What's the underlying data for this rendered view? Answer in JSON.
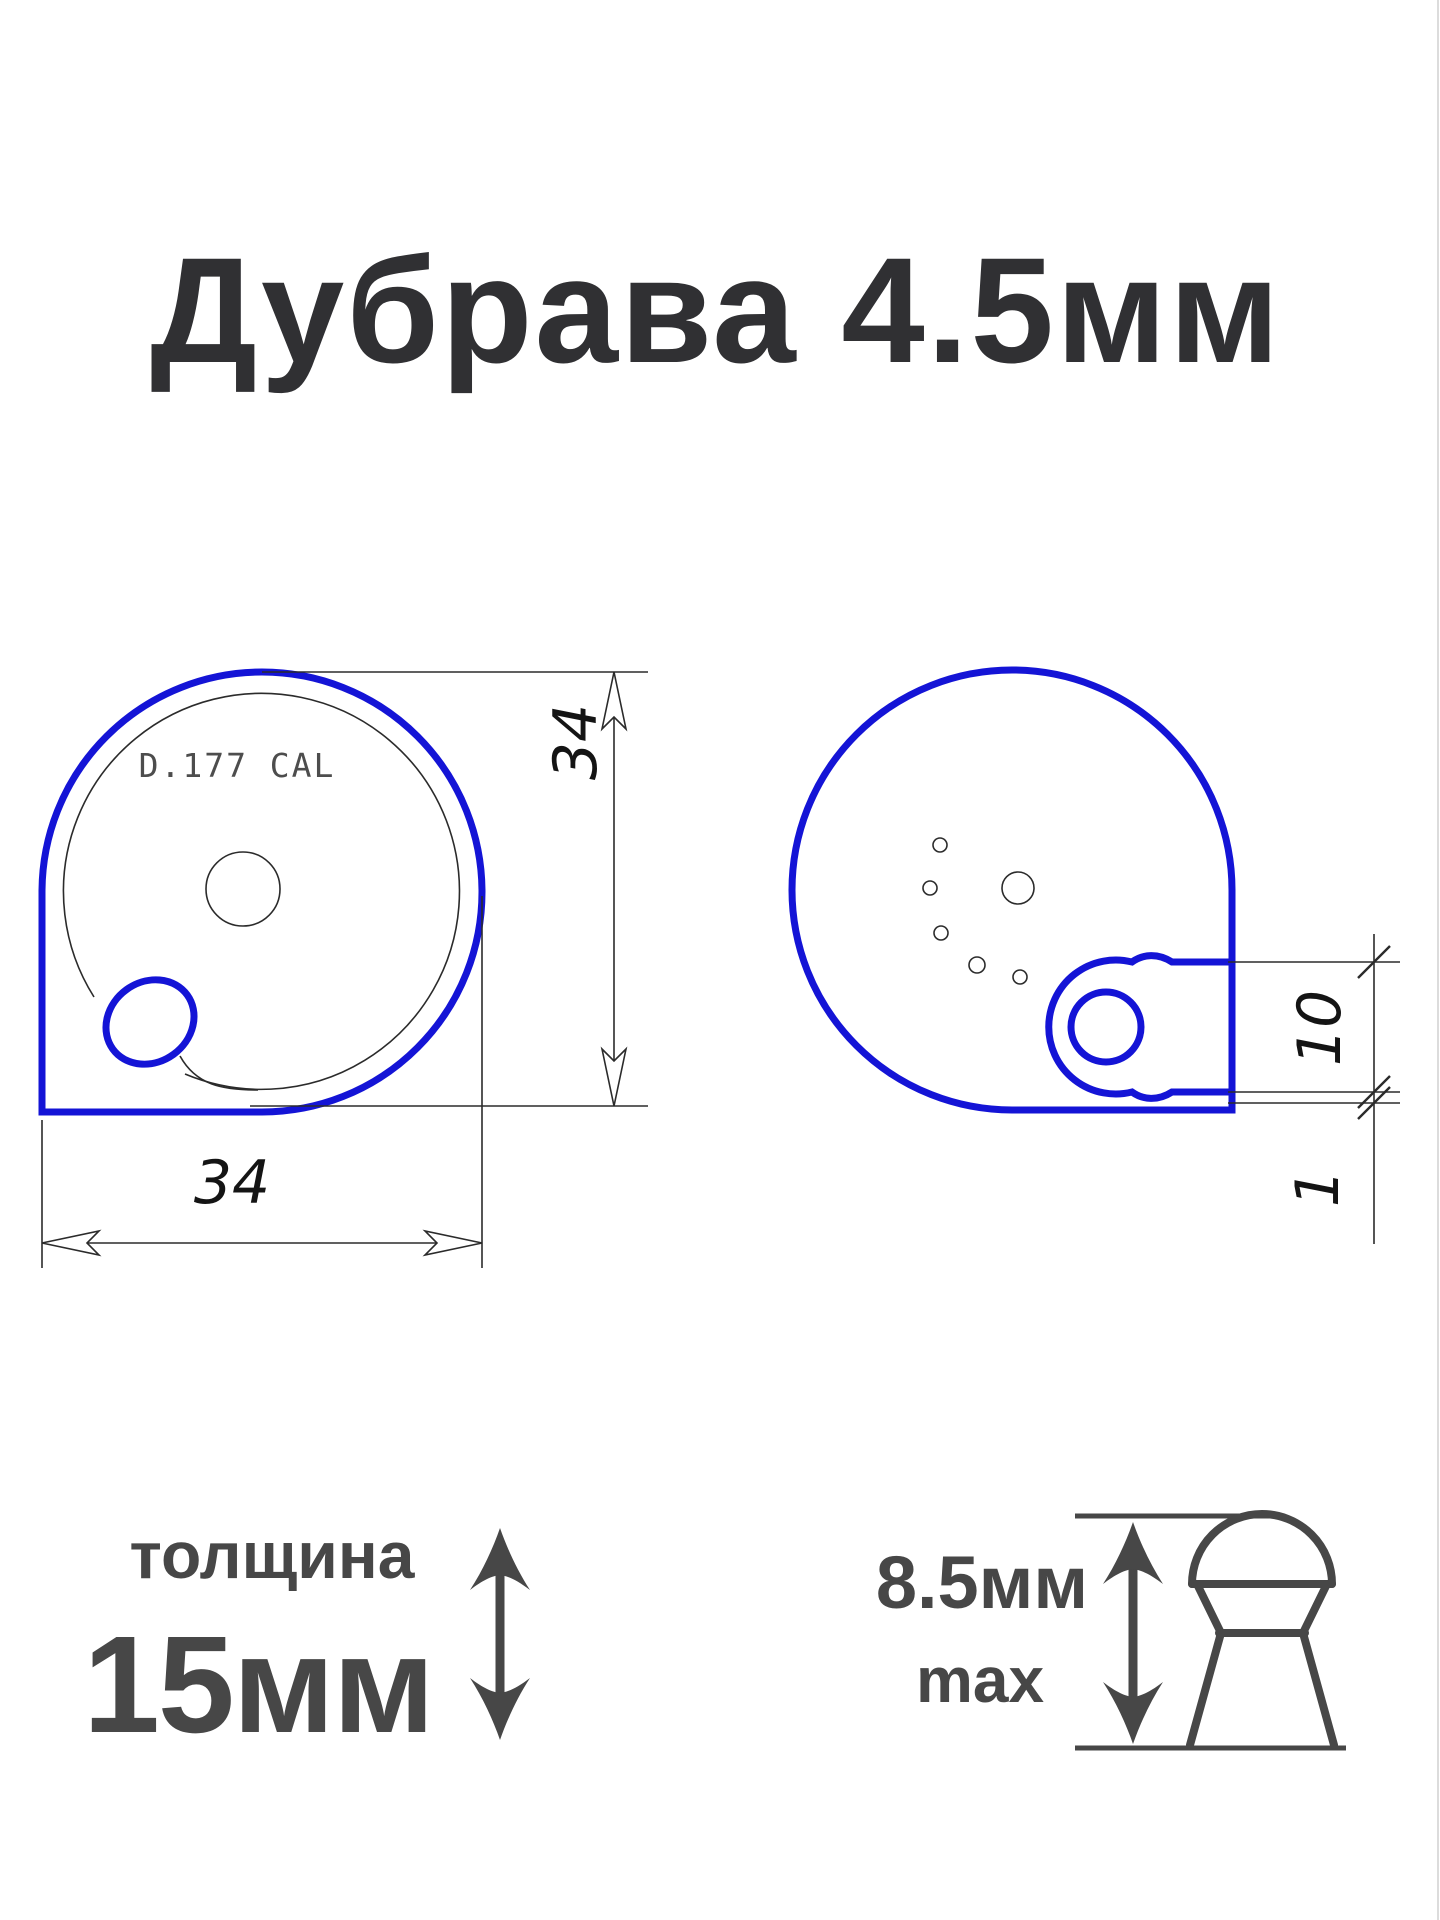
{
  "title": "Дубрава 4.5мм",
  "colors": {
    "outline_blue": "#1414d6",
    "thin_line": "#2b2b2b",
    "dimension_text": "#141414",
    "title_text": "#303033",
    "label_text": "#474747",
    "engraving_text": "#4d4d4d",
    "background": "#ffffff"
  },
  "front_view": {
    "engraving": "D.177 CAL",
    "width_dim": "34",
    "height_dim": "34"
  },
  "back_view": {
    "ear_height_dim": "10",
    "lip_dim": "1"
  },
  "thickness_note": {
    "label": "толщина",
    "value": "15мм"
  },
  "pellet_note": {
    "height": "8.5мм",
    "qualifier": "max"
  }
}
